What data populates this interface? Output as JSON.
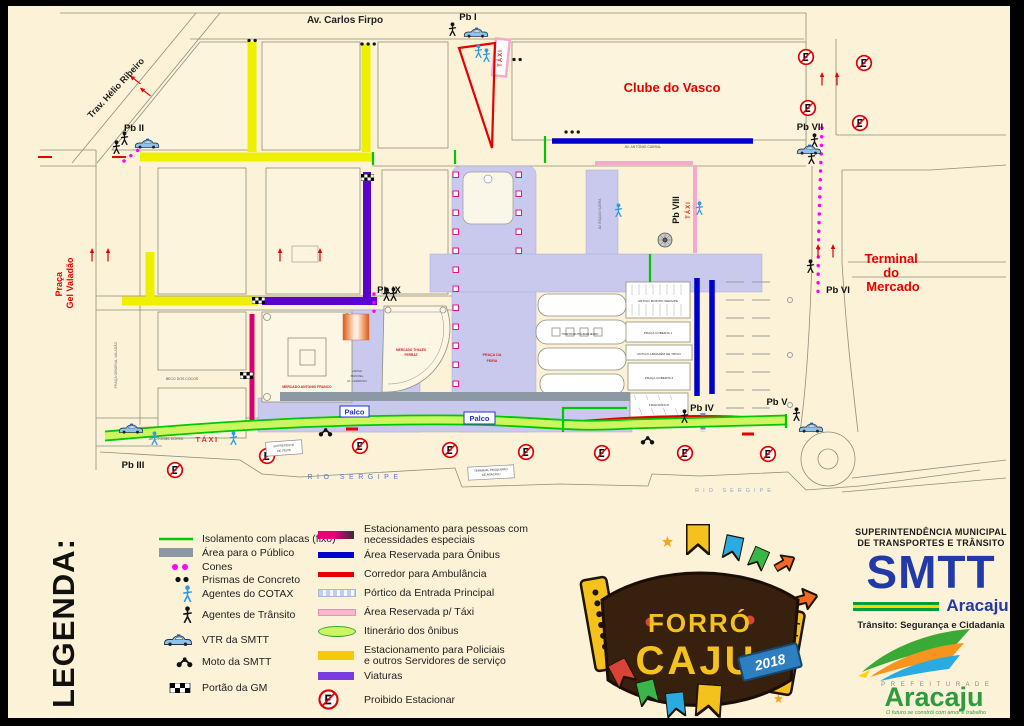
{
  "map": {
    "labels": {
      "av_carlos_firpo": "Av. Carlos Firpo",
      "trav_helio_ribeiro": "Trav. Hélio Ribeiro",
      "av_antonio_cabral": "AV.  ANTÔNIO  CABRAL",
      "av_otoniel_dorea": "AV.  OTONIEL  DÓREA",
      "av_esquio_sueira": "AV. ÉSQUIO SUEIRA",
      "beco_dos_cocos": "BECO  DOS  COCOS",
      "clube_do_vasco": "Clube do Vasco",
      "terminal_line1": "Terminal",
      "terminal_line2": "do",
      "terminal_line3": "Mercado",
      "praca_line1": "Praça",
      "praca_line2": "Gel Valadão",
      "praca_general_valadao": "PRAÇA  GENERAL  VALADÃO",
      "praca_da_feira_1": "PRAÇA  DA",
      "praca_da_feira_2": "FEIRA",
      "rio_sergipe": "RIO   SERGIPE",
      "taxi": "TÁXI",
      "palco": "Palco",
      "mercado_antonio_franco": "MERCADO  ANTONIO  FRANCO",
      "mercado_thales_1": "MERCADO  THALES",
      "mercado_thales_2": "FERRAZ",
      "largo_1": "LARGO",
      "largo_2": "MANOEL",
      "largo_3": "M. CARDOSO",
      "antigo_moinho": "ANTIGO  MOINHO  SERGIPE",
      "hortifrutigranjeiro": "HORTIFRUTIGRANJEIRO",
      "praca_coberta_1": "PRAÇA  COBERTA  1",
      "antigo_armazem": "ANTIGO  ARMAZÉM  DE  TRIGO",
      "praca_coberta_2": "PRAÇA  COBERTA  2",
      "frigorifico": "FRIGORÍFICO",
      "entreposto_1": "ENTREPOSTO",
      "entreposto_2": "DE PEIXE",
      "terminal_pesqueiro_1": "TERMINAL PESQUEIRO",
      "terminal_pesqueiro_2": "DE ARACAJU"
    },
    "posts": {
      "pb1": "Pb I",
      "pb2": "Pb II",
      "pb3": "Pb III",
      "pb4": "Pb IV",
      "pb5": "Pb V",
      "pb6": "Pb VI",
      "pb7": "Pb VII",
      "pb8": "Pb VIII",
      "pb9": "Pb IX"
    }
  },
  "legend": {
    "title": "LEGENDA:",
    "col1": [
      {
        "label": "Isolamento com placas (fixo)"
      },
      {
        "label": "Área para o Público"
      },
      {
        "label": "Cones"
      },
      {
        "label": "Prismas de Concreto"
      },
      {
        "label": "Agentes do COTAX"
      },
      {
        "label": "Agentes de Trânsito"
      },
      {
        "label": "VTR da SMTT"
      },
      {
        "label": "Moto da SMTT"
      },
      {
        "label": "Portão da GM"
      }
    ],
    "col2": [
      {
        "lines": [
          "Estacionamento para pessoas com",
          "necessidades especiais"
        ]
      },
      {
        "lines": [
          "Área Reservada para Ônibus"
        ]
      },
      {
        "lines": [
          "Corredor para Ambulância"
        ]
      },
      {
        "lines": [
          "Pórtico da Entrada Principal"
        ]
      },
      {
        "lines": [
          "Área Reservada p/ Táxi"
        ]
      },
      {
        "lines": [
          "Itinerário dos ônibus"
        ]
      },
      {
        "lines": [
          "Estacionamento para Policiais",
          "e outros Servidores de serviço"
        ]
      },
      {
        "lines": [
          "Viaturas"
        ]
      },
      {
        "lines": [
          "Proibido Estacionar"
        ]
      }
    ]
  },
  "branding": {
    "smtt": {
      "line1": "SUPERINTENDÊNCIA MUNICIPAL",
      "line2": "DE TRANSPORTES E TRÂNSITO",
      "name": "SMTT",
      "city": "Aracaju",
      "tagline": "Trânsito: Segurança e Cidadania"
    },
    "forro": {
      "word1": "FORRÓ",
      "word2": "CAJU",
      "year": "2018"
    },
    "prefeitura": {
      "small": "P R E F E I T U R A   D E",
      "name": "Aracaju",
      "tagline": "O futuro se constrói com amor e trabalho"
    }
  },
  "colors": {
    "paper": "#FBF2D7",
    "police_yellow": "#EFEF00",
    "viaturas_purple": "#5A00D0",
    "bus_blue": "#0000CC",
    "ambulance_red": "#E60000",
    "taxi_pink": "#F9A8CD",
    "cones_magenta": "#FF00FF",
    "isolation_green": "#00C800",
    "itinerary_green": "#CDF55F",
    "public_lavender": "#C9C9ED",
    "public_gray": "#8C99A5",
    "special_parking": "#D6006E"
  }
}
